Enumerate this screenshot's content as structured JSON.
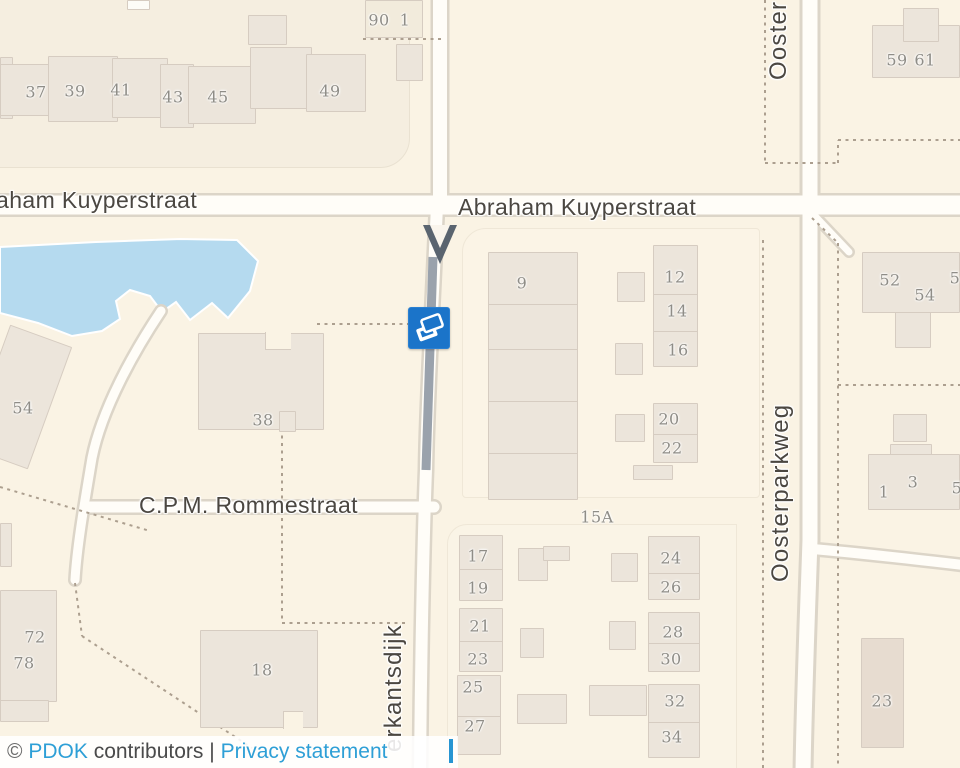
{
  "map": {
    "street_labels": {
      "abraham_kuyperstraat_partial_left": "aham Kuyperstraat",
      "abraham_kuyperstraat": "Abraham Kuyperstraat",
      "cpm_rommestraat": "C.P.M. Rommestraat",
      "oosterparkweg_partial_top": "Ooster",
      "oosterparkweg": "Oosterparkweg",
      "erkantsdijk_partial": "erkantsdijk"
    },
    "house_numbers": [
      {
        "t": "37",
        "x": 36,
        "y": 92
      },
      {
        "t": "39",
        "x": 75,
        "y": 91
      },
      {
        "t": "41",
        "x": 121,
        "y": 90
      },
      {
        "t": "43",
        "x": 173,
        "y": 97
      },
      {
        "t": "45",
        "x": 218,
        "y": 97
      },
      {
        "t": "49",
        "x": 330,
        "y": 91
      },
      {
        "t": "90",
        "x": 379,
        "y": 20
      },
      {
        "t": "1",
        "x": 405,
        "y": 20
      },
      {
        "t": "59",
        "x": 897,
        "y": 60
      },
      {
        "t": "61",
        "x": 925,
        "y": 60
      },
      {
        "t": "9",
        "x": 522,
        "y": 283
      },
      {
        "t": "12",
        "x": 675,
        "y": 277
      },
      {
        "t": "14",
        "x": 677,
        "y": 311
      },
      {
        "t": "16",
        "x": 678,
        "y": 350
      },
      {
        "t": "20",
        "x": 669,
        "y": 419
      },
      {
        "t": "22",
        "x": 672,
        "y": 448
      },
      {
        "t": "52",
        "x": 890,
        "y": 280
      },
      {
        "t": "54",
        "x": 925,
        "y": 295
      },
      {
        "t": "5",
        "x": 955,
        "y": 278
      },
      {
        "t": "54",
        "x": 23,
        "y": 408
      },
      {
        "t": "38",
        "x": 263,
        "y": 420
      },
      {
        "t": "15A",
        "x": 597,
        "y": 517
      },
      {
        "t": "1",
        "x": 884,
        "y": 492
      },
      {
        "t": "3",
        "x": 913,
        "y": 482
      },
      {
        "t": "5",
        "x": 957,
        "y": 488
      },
      {
        "t": "17",
        "x": 478,
        "y": 556
      },
      {
        "t": "19",
        "x": 478,
        "y": 588
      },
      {
        "t": "21",
        "x": 480,
        "y": 626
      },
      {
        "t": "23",
        "x": 478,
        "y": 659
      },
      {
        "t": "25",
        "x": 473,
        "y": 687
      },
      {
        "t": "27",
        "x": 475,
        "y": 726
      },
      {
        "t": "24",
        "x": 671,
        "y": 558
      },
      {
        "t": "26",
        "x": 671,
        "y": 587
      },
      {
        "t": "28",
        "x": 673,
        "y": 632
      },
      {
        "t": "30",
        "x": 671,
        "y": 659
      },
      {
        "t": "32",
        "x": 675,
        "y": 701
      },
      {
        "t": "34",
        "x": 672,
        "y": 737
      },
      {
        "t": "72",
        "x": 35,
        "y": 637
      },
      {
        "t": "78",
        "x": 24,
        "y": 663
      },
      {
        "t": "18",
        "x": 262,
        "y": 670
      },
      {
        "t": "23",
        "x": 882,
        "y": 701
      }
    ],
    "icons": {
      "marker": "layers-icon",
      "route_arrow": "downward-direction-arrow"
    },
    "colors": {
      "land": "#faf3e4",
      "water": "#b5daef",
      "building": "#ece5db",
      "road": "#fffdf8",
      "road_casing": "#dcd5c8",
      "highlight_segment": "#9aa2ac",
      "marker_blue": "#1b74c9",
      "boundary_dash": "#ac9f8f",
      "link_blue": "#2e9fd6"
    }
  },
  "attribution": {
    "copyright": "©",
    "pdok": "PDOK",
    "contributors": "contributors",
    "separator": "|",
    "privacy": "Privacy statement"
  }
}
